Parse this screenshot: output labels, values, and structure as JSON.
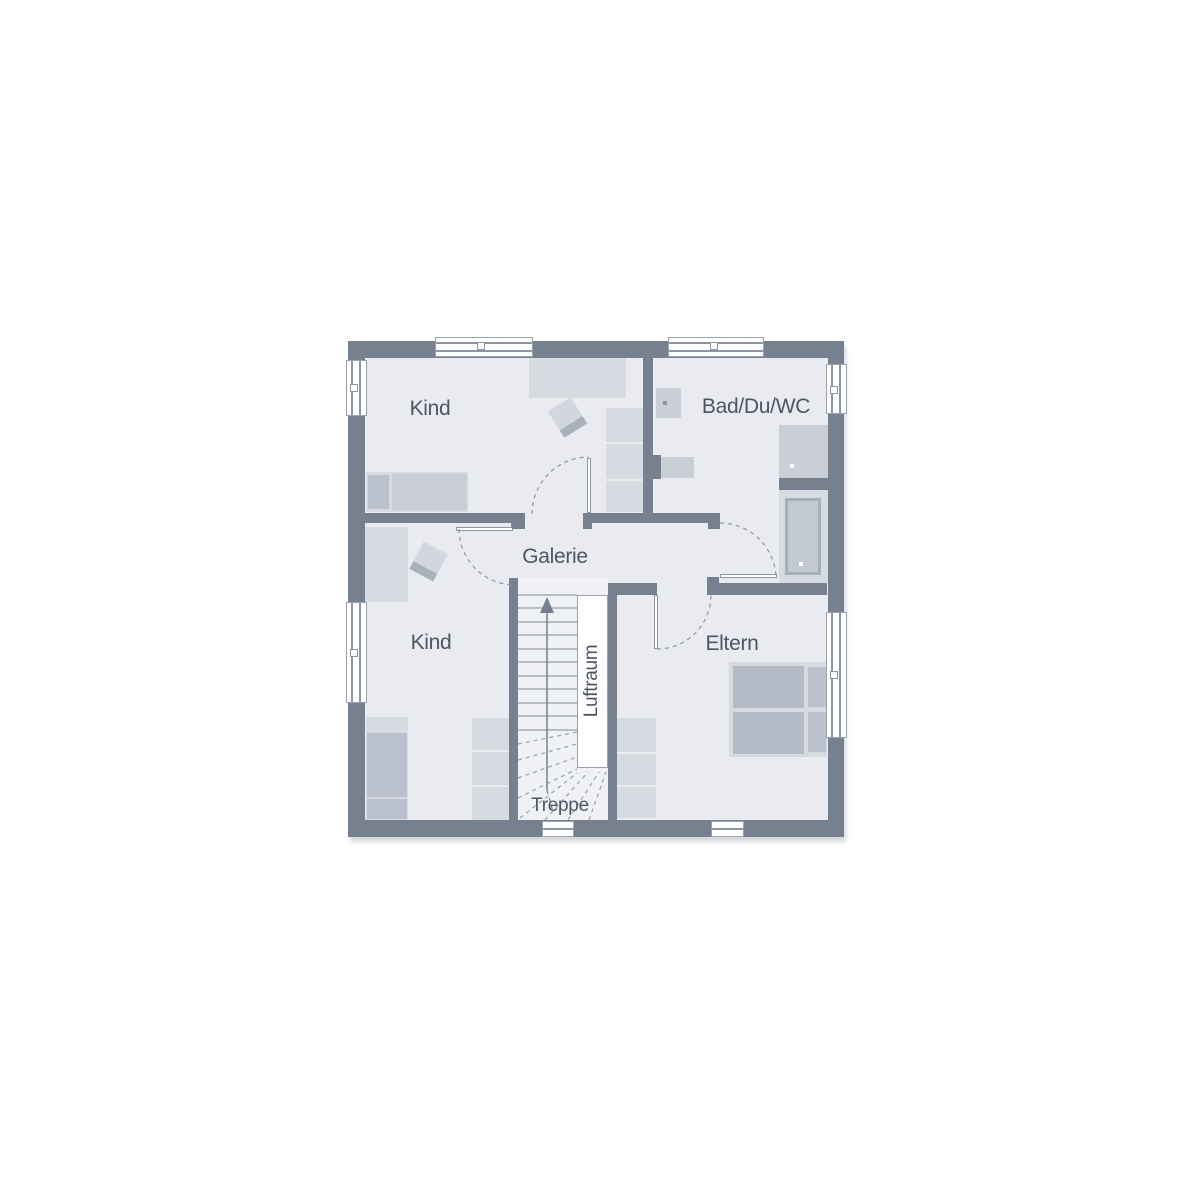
{
  "meta": {
    "title": "Floor plan – upper storey",
    "canvas_w": 1200,
    "canvas_h": 1200
  },
  "colors": {
    "page": "#FFFFFF",
    "wall": "#76808E",
    "floor": "#E9EBF0",
    "stairFloor": "#EFF1F5",
    "white": "#FFFFFF",
    "furnA": "#D6DAE1",
    "furnB": "#C9CED7",
    "furnC": "#BAC1CC",
    "furnD": "#B4BBC6",
    "line": "#97A0AE",
    "frame": "#8D96A4",
    "border": "#9AA2B0",
    "text": "#4D5663",
    "tubRim": "#A6AEBB",
    "tubFill": "#C3C9D2",
    "chairGrad": "linear-gradient(to bottom,#D2D6DE 0 72%,#A9B1BD 72% 100%)"
  },
  "labels": [
    {
      "name": "room-label-kind-upper",
      "text": "Kind",
      "x": 430,
      "y": 409,
      "size": 21,
      "rot": 0
    },
    {
      "name": "room-label-bad-du-wc",
      "text": "Bad/Du/WC",
      "x": 756,
      "y": 407,
      "size": 21,
      "rot": 0
    },
    {
      "name": "area-label-galerie",
      "text": "Galerie",
      "x": 555,
      "y": 557,
      "size": 21,
      "rot": 0
    },
    {
      "name": "room-label-kind-lower",
      "text": "Kind",
      "x": 431,
      "y": 643,
      "size": 21,
      "rot": 0
    },
    {
      "name": "room-label-eltern",
      "text": "Eltern",
      "x": 732,
      "y": 644,
      "size": 21,
      "rot": 0
    },
    {
      "name": "area-label-luftraum",
      "text": "Luftraum",
      "x": 592,
      "y": 681,
      "size": 19,
      "rot": -90
    },
    {
      "name": "area-label-treppe",
      "text": "Treppe",
      "x": 560,
      "y": 806,
      "size": 19,
      "rot": 0
    }
  ],
  "rects": [
    {
      "name": "exterior-wall-block",
      "x": 348,
      "y": 341,
      "w": 496,
      "h": 496,
      "c": "wall",
      "sh": "2px 5px 4px rgba(165,170,180,0.45)"
    },
    {
      "name": "interior-floor",
      "x": 365,
      "y": 358,
      "w": 463,
      "h": 462,
      "c": "floor"
    },
    {
      "name": "stairwell-floor",
      "x": 518,
      "y": 578,
      "w": 90,
      "h": 242,
      "c": "stairFloor"
    },
    {
      "name": "desk-kind-upper",
      "x": 529,
      "y": 358,
      "w": 97,
      "h": 40,
      "c": "furnA"
    },
    {
      "name": "shelf-kind-upper-1",
      "x": 606,
      "y": 408,
      "w": 37,
      "h": 34,
      "c": "furnA"
    },
    {
      "name": "shelf-kind-upper-2",
      "x": 606,
      "y": 444,
      "w": 37,
      "h": 35,
      "c": "furnA"
    },
    {
      "name": "shelf-kind-upper-3",
      "x": 606,
      "y": 481,
      "w": 37,
      "h": 31,
      "c": "furnA"
    },
    {
      "name": "bed-kind-upper",
      "x": 366,
      "y": 472,
      "w": 102,
      "h": 40,
      "c": "furnA"
    },
    {
      "name": "bed-kind-upper-pillow",
      "x": 368,
      "y": 475,
      "w": 21,
      "h": 34,
      "c": "furnC"
    },
    {
      "name": "bed-kind-upper-mattress",
      "x": 392,
      "y": 474,
      "w": 75,
      "h": 36,
      "c": "furnB"
    },
    {
      "name": "chair-kind-upper",
      "x": 554,
      "y": 402,
      "w": 27,
      "h": 31,
      "g": "chairGrad",
      "rot": -32
    },
    {
      "name": "bed-kind-lower",
      "x": 365,
      "y": 527,
      "w": 43,
      "h": 75,
      "c": "furnA"
    },
    {
      "name": "chair-kind-lower",
      "x": 415,
      "y": 546,
      "w": 27,
      "h": 31,
      "g": "chairGrad",
      "rot": 28
    },
    {
      "name": "wardrobe-kind-lower",
      "x": 366,
      "y": 717,
      "w": 42,
      "h": 103,
      "c": "furnA"
    },
    {
      "name": "wardrobe-kind-lower-door1",
      "x": 367,
      "y": 733,
      "w": 40,
      "h": 64,
      "c": "furnC"
    },
    {
      "name": "wardrobe-kind-lower-door2",
      "x": 367,
      "y": 799,
      "w": 40,
      "h": 20,
      "c": "furnC"
    },
    {
      "name": "shelf-kind-lower-1",
      "x": 472,
      "y": 718,
      "w": 37,
      "h": 32,
      "c": "furnA"
    },
    {
      "name": "shelf-kind-lower-2",
      "x": 472,
      "y": 752,
      "w": 37,
      "h": 33,
      "c": "furnA"
    },
    {
      "name": "shelf-kind-lower-3",
      "x": 472,
      "y": 787,
      "w": 37,
      "h": 33,
      "c": "furnA"
    },
    {
      "name": "washbasin",
      "x": 656,
      "y": 388,
      "w": 25,
      "h": 30,
      "c": "furnB"
    },
    {
      "name": "washbasin-drain-dot",
      "x": 663,
      "y": 401,
      "w": 4,
      "h": 4,
      "c": "frame"
    },
    {
      "name": "wc",
      "x": 661,
      "y": 457,
      "w": 33,
      "h": 21,
      "c": "furnB"
    },
    {
      "name": "shower-tray",
      "x": 779,
      "y": 425,
      "w": 49,
      "h": 53,
      "c": "furnB"
    },
    {
      "name": "shower-drain-dot",
      "x": 790,
      "y": 464,
      "w": 4,
      "h": 4,
      "c": "white"
    },
    {
      "name": "bathtub-surround",
      "x": 779,
      "y": 490,
      "w": 49,
      "h": 93,
      "c": "furnA"
    },
    {
      "name": "bathtub-rim",
      "x": 785,
      "y": 498,
      "w": 36,
      "h": 77,
      "c": "tubRim"
    },
    {
      "name": "bathtub-basin",
      "x": 788,
      "y": 501,
      "w": 30,
      "h": 71,
      "c": "tubFill"
    },
    {
      "name": "bathtub-drain-dot",
      "x": 799,
      "y": 562,
      "w": 4,
      "h": 4,
      "c": "white"
    },
    {
      "name": "bed-eltern",
      "x": 729,
      "y": 662,
      "w": 98,
      "h": 95,
      "c": "furnA"
    },
    {
      "name": "bed-eltern-mattress1",
      "x": 733,
      "y": 666,
      "w": 71,
      "h": 42,
      "c": "furnD"
    },
    {
      "name": "bed-eltern-mattress2",
      "x": 733,
      "y": 712,
      "w": 71,
      "h": 42,
      "c": "furnD"
    },
    {
      "name": "bed-eltern-pillow1",
      "x": 808,
      "y": 667,
      "w": 18,
      "h": 40,
      "c": "furnC"
    },
    {
      "name": "bed-eltern-pillow2",
      "x": 808,
      "y": 712,
      "w": 18,
      "h": 40,
      "c": "furnC"
    },
    {
      "name": "wardrobe-eltern-1",
      "x": 617,
      "y": 718,
      "w": 39,
      "h": 34,
      "c": "furnA"
    },
    {
      "name": "wardrobe-eltern-2",
      "x": 617,
      "y": 754,
      "w": 39,
      "h": 31,
      "c": "furnA"
    },
    {
      "name": "wardrobe-eltern-3",
      "x": 617,
      "y": 787,
      "w": 39,
      "h": 31,
      "c": "furnA"
    },
    {
      "name": "wall-galerie-north-west",
      "x": 365,
      "y": 513,
      "w": 160,
      "h": 10,
      "c": "wall"
    },
    {
      "name": "wall-step-kind-lower-jamb",
      "x": 511,
      "y": 523,
      "w": 14,
      "h": 6,
      "c": "wall"
    },
    {
      "name": "wall-galerie-north-east",
      "x": 583,
      "y": 513,
      "w": 137,
      "h": 10,
      "c": "wall"
    },
    {
      "name": "wall-step-kind-upper-jamb",
      "x": 583,
      "y": 523,
      "w": 9,
      "h": 6,
      "c": "wall"
    },
    {
      "name": "wall-step-bad-jamb",
      "x": 708,
      "y": 523,
      "w": 12,
      "h": 6,
      "c": "wall"
    },
    {
      "name": "wall-bad-west",
      "x": 643,
      "y": 358,
      "w": 10,
      "h": 155,
      "c": "wall"
    },
    {
      "name": "wall-pier-wc",
      "x": 644,
      "y": 455,
      "w": 17,
      "h": 24,
      "c": "wall"
    },
    {
      "name": "wall-stairwell-west",
      "x": 509,
      "y": 578,
      "w": 9,
      "h": 242,
      "c": "wall"
    },
    {
      "name": "wall-stairwell-east",
      "x": 608,
      "y": 593,
      "w": 9,
      "h": 227,
      "c": "wall"
    },
    {
      "name": "wall-eltern-north-west",
      "x": 608,
      "y": 583,
      "w": 49,
      "h": 12,
      "c": "wall"
    },
    {
      "name": "wall-eltern-north-east",
      "x": 707,
      "y": 583,
      "w": 120,
      "h": 12,
      "c": "wall"
    },
    {
      "name": "wall-step-eltern-jamb",
      "x": 707,
      "y": 577,
      "w": 12,
      "h": 6,
      "c": "wall"
    },
    {
      "name": "wall-shower-tub-divider",
      "x": 779,
      "y": 478,
      "w": 49,
      "h": 12,
      "c": "wall"
    },
    {
      "name": "luftraum-void",
      "x": 577,
      "y": 595,
      "w": 31,
      "h": 173,
      "c": "white",
      "b": "border"
    },
    {
      "name": "door-leaf-kind-upper",
      "x": 587,
      "y": 458,
      "w": 4,
      "h": 55,
      "c": "white",
      "b": "frame"
    },
    {
      "name": "door-leaf-kind-lower",
      "x": 456,
      "y": 527,
      "w": 57,
      "h": 4,
      "c": "white",
      "b": "frame"
    },
    {
      "name": "door-leaf-bad",
      "x": 720,
      "y": 574,
      "w": 57,
      "h": 4,
      "c": "white",
      "b": "frame"
    },
    {
      "name": "door-leaf-eltern",
      "x": 654,
      "y": 595,
      "w": 4,
      "h": 54,
      "c": "white",
      "b": "frame"
    },
    {
      "name": "window-north-kind",
      "x": 435,
      "y": 337,
      "w": 98,
      "h": 20,
      "c": "white",
      "b": "border"
    },
    {
      "name": "window-north-kind-bar1",
      "x": 436,
      "y": 342,
      "w": 96,
      "h": 1.5,
      "c": "frame"
    },
    {
      "name": "window-north-kind-bar2",
      "x": 436,
      "y": 350,
      "w": 96,
      "h": 1.5,
      "c": "frame"
    },
    {
      "name": "window-north-kind-tick",
      "x": 477,
      "y": 342,
      "w": 8,
      "h": 8,
      "c": "white",
      "b": "frame"
    },
    {
      "name": "window-north-bad",
      "x": 668,
      "y": 337,
      "w": 96,
      "h": 20,
      "c": "white",
      "b": "border"
    },
    {
      "name": "window-north-bad-bar1",
      "x": 669,
      "y": 342,
      "w": 94,
      "h": 1.5,
      "c": "frame"
    },
    {
      "name": "window-north-bad-bar2",
      "x": 669,
      "y": 350,
      "w": 94,
      "h": 1.5,
      "c": "frame"
    },
    {
      "name": "window-north-bad-tick",
      "x": 710,
      "y": 342,
      "w": 8,
      "h": 8,
      "c": "white",
      "b": "frame"
    },
    {
      "name": "window-west-kind-upper",
      "x": 346,
      "y": 360,
      "w": 21,
      "h": 56,
      "c": "white",
      "b": "border"
    },
    {
      "name": "window-west-kind-upper-bar1",
      "x": 351,
      "y": 361,
      "w": 1.5,
      "h": 54,
      "c": "frame"
    },
    {
      "name": "window-west-kind-upper-bar2",
      "x": 359,
      "y": 361,
      "w": 1.5,
      "h": 54,
      "c": "frame"
    },
    {
      "name": "window-west-kind-upper-tick",
      "x": 350,
      "y": 384,
      "w": 8,
      "h": 8,
      "c": "white",
      "b": "frame"
    },
    {
      "name": "window-west-kind-lower",
      "x": 346,
      "y": 602,
      "w": 21,
      "h": 101,
      "c": "white",
      "b": "border"
    },
    {
      "name": "window-west-kind-lower-bar1",
      "x": 351,
      "y": 603,
      "w": 1.5,
      "h": 99,
      "c": "frame"
    },
    {
      "name": "window-west-kind-lower-bar2",
      "x": 359,
      "y": 603,
      "w": 1.5,
      "h": 99,
      "c": "frame"
    },
    {
      "name": "window-west-kind-lower-tick",
      "x": 350,
      "y": 649,
      "w": 8,
      "h": 8,
      "c": "white",
      "b": "frame"
    },
    {
      "name": "window-east-bad",
      "x": 826,
      "y": 364,
      "w": 21,
      "h": 50,
      "c": "white",
      "b": "border"
    },
    {
      "name": "window-east-bad-bar1",
      "x": 831,
      "y": 365,
      "w": 1.5,
      "h": 48,
      "c": "frame"
    },
    {
      "name": "window-east-bad-bar2",
      "x": 839,
      "y": 365,
      "w": 1.5,
      "h": 48,
      "c": "frame"
    },
    {
      "name": "window-east-bad-tick",
      "x": 830,
      "y": 386,
      "w": 8,
      "h": 8,
      "c": "white",
      "b": "frame"
    },
    {
      "name": "window-east-eltern",
      "x": 826,
      "y": 612,
      "w": 21,
      "h": 126,
      "c": "white",
      "b": "border"
    },
    {
      "name": "window-east-eltern-bar1",
      "x": 831,
      "y": 613,
      "w": 1.5,
      "h": 124,
      "c": "frame"
    },
    {
      "name": "window-east-eltern-bar2",
      "x": 839,
      "y": 613,
      "w": 1.5,
      "h": 124,
      "c": "frame"
    },
    {
      "name": "window-east-eltern-tick",
      "x": 830,
      "y": 671,
      "w": 8,
      "h": 8,
      "c": "white",
      "b": "frame"
    },
    {
      "name": "window-south-treppe",
      "x": 542,
      "y": 821,
      "w": 32,
      "h": 16,
      "c": "white",
      "b": "border"
    },
    {
      "name": "window-south-treppe-bar",
      "x": 543,
      "y": 828,
      "w": 30,
      "h": 1.5,
      "c": "frame"
    },
    {
      "name": "window-south-eltern",
      "x": 711,
      "y": 821,
      "w": 33,
      "h": 16,
      "c": "white",
      "b": "border"
    },
    {
      "name": "window-south-eltern-bar",
      "x": 712,
      "y": 828,
      "w": 31,
      "h": 1.5,
      "c": "frame"
    }
  ],
  "stairs": {
    "treads": [
      {
        "x1": 518,
        "y1": 595,
        "x2": 577,
        "y2": 595
      },
      {
        "x1": 518,
        "y1": 608,
        "x2": 577,
        "y2": 608
      },
      {
        "x1": 518,
        "y1": 622,
        "x2": 577,
        "y2": 622
      },
      {
        "x1": 518,
        "y1": 635,
        "x2": 577,
        "y2": 635
      },
      {
        "x1": 518,
        "y1": 649,
        "x2": 577,
        "y2": 649
      },
      {
        "x1": 518,
        "y1": 662,
        "x2": 577,
        "y2": 662
      },
      {
        "x1": 518,
        "y1": 676,
        "x2": 577,
        "y2": 676
      },
      {
        "x1": 518,
        "y1": 689,
        "x2": 577,
        "y2": 689
      },
      {
        "x1": 518,
        "y1": 703,
        "x2": 577,
        "y2": 703
      },
      {
        "x1": 518,
        "y1": 716,
        "x2": 577,
        "y2": 716
      },
      {
        "x1": 518,
        "y1": 730,
        "x2": 577,
        "y2": 730
      }
    ],
    "winders_dashed": [
      {
        "x1": 518,
        "y1": 744,
        "x2": 577,
        "y2": 732
      },
      {
        "x1": 518,
        "y1": 760,
        "x2": 577,
        "y2": 744
      },
      {
        "x1": 518,
        "y1": 778,
        "x2": 577,
        "y2": 757
      },
      {
        "x1": 518,
        "y1": 798,
        "x2": 577,
        "y2": 769
      },
      {
        "x1": 520,
        "y1": 818,
        "x2": 577,
        "y2": 773
      },
      {
        "x1": 545,
        "y1": 820,
        "x2": 588,
        "y2": 772
      },
      {
        "x1": 568,
        "y1": 820,
        "x2": 599,
        "y2": 772
      },
      {
        "x1": 589,
        "y1": 820,
        "x2": 606,
        "y2": 772
      }
    ],
    "walking_line": {
      "x1": 547,
      "y1": 612,
      "x2": 547,
      "y2": 790
    },
    "walking_line_dashed": {
      "x1": 547,
      "y1": 790,
      "x2": 553,
      "y2": 812
    },
    "arrow_points": "547,597 540,613 554,613"
  },
  "door_arcs": [
    {
      "name": "door-arc-kind-upper",
      "d": "M532,514 A57,57 0 0 1 589,457"
    },
    {
      "name": "door-arc-kind-lower",
      "d": "M459,529 A56,56 0 0 0 515,585"
    },
    {
      "name": "door-arc-bad",
      "d": "M720,523 A56,56 0 0 1 776,579"
    },
    {
      "name": "door-arc-eltern",
      "d": "M657,649 A54,54 0 0 0 711,595"
    }
  ]
}
